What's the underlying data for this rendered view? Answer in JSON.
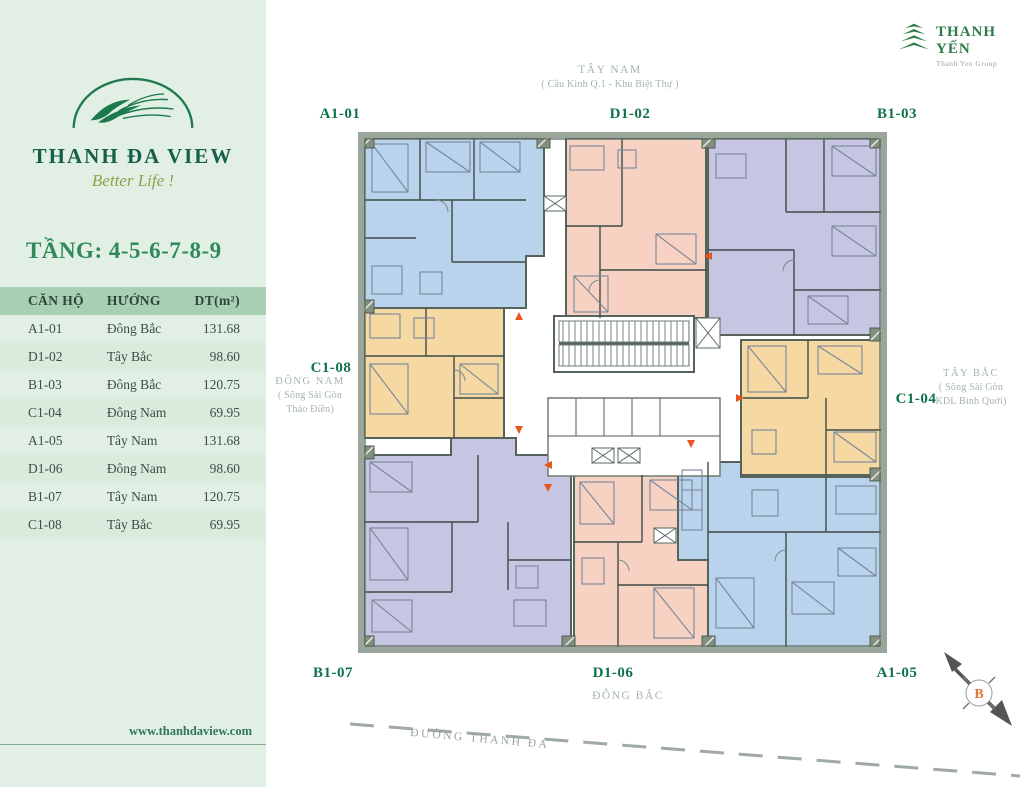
{
  "sidebar": {
    "logo": {
      "title": "THANH ĐA VIEW",
      "tagline": "Better Life !"
    },
    "floor_title": "TẦNG: 4-5-6-7-8-9",
    "table": {
      "headers": [
        "CĂN HỘ",
        "HƯỚNG",
        "DT(m²)"
      ],
      "rows": [
        {
          "unit": "A1-01",
          "direction": "Đông Bắc",
          "area": "131.68"
        },
        {
          "unit": "D1-02",
          "direction": "Tây Bắc",
          "area": "98.60"
        },
        {
          "unit": "B1-03",
          "direction": "Đông Bắc",
          "area": "120.75"
        },
        {
          "unit": "C1-04",
          "direction": "Đông Nam",
          "area": "69.95"
        },
        {
          "unit": "A1-05",
          "direction": "Tây Nam",
          "area": "131.68"
        },
        {
          "unit": "D1-06",
          "direction": "Đông Nam",
          "area": "98.60"
        },
        {
          "unit": "B1-07",
          "direction": "Tây Nam",
          "area": "120.75"
        },
        {
          "unit": "C1-08",
          "direction": "Tây Bắc",
          "area": "69.95"
        }
      ]
    },
    "website": "www.thanhdaview.com"
  },
  "brand": {
    "name": "THANH YẾN",
    "subtitle": "Thanh Yen Group"
  },
  "plan": {
    "unit_labels": {
      "top_left": "A1-01",
      "top_center": "D1-02",
      "top_right": "B1-03",
      "left": "C1-08",
      "right": "C1-04",
      "bottom_left": "B1-07",
      "bottom_center": "D1-06",
      "bottom_right": "A1-05"
    },
    "directions": {
      "top": {
        "label": "TÂY NAM",
        "sub": "( Cầu Kinh Q.1 - Khu Biệt Thự )"
      },
      "left": {
        "label": "ĐÔNG NAM",
        "sub1": "( Sông Sài Gòn",
        "sub2": "Thảo Điền)"
      },
      "right": {
        "label": "TÂY BẮC",
        "sub1": "( Sông Sài Gòn",
        "sub2": "KDL Bình Quới)"
      },
      "bottom": {
        "label": "ĐÔNG BẮC"
      }
    },
    "road_label": "ĐƯỜNG THANH ĐA",
    "compass_letter": "B",
    "unit_colors": {
      "A1": "#b9d3ec",
      "B1": "#c7c6e2",
      "C1": "#f6d8a2",
      "D1": "#f7d2c3"
    }
  },
  "colors": {
    "sidebar_bg": "#e1efe5",
    "table_header_bg": "#a9cfb2",
    "table_row_alt_bg": "#d9ebdc",
    "brand_green": "#16604a",
    "label_green": "#0e7447",
    "muted_green": "#a3b5a9",
    "wall_gray": "#55635a",
    "arrow_orange": "#e8561e"
  }
}
